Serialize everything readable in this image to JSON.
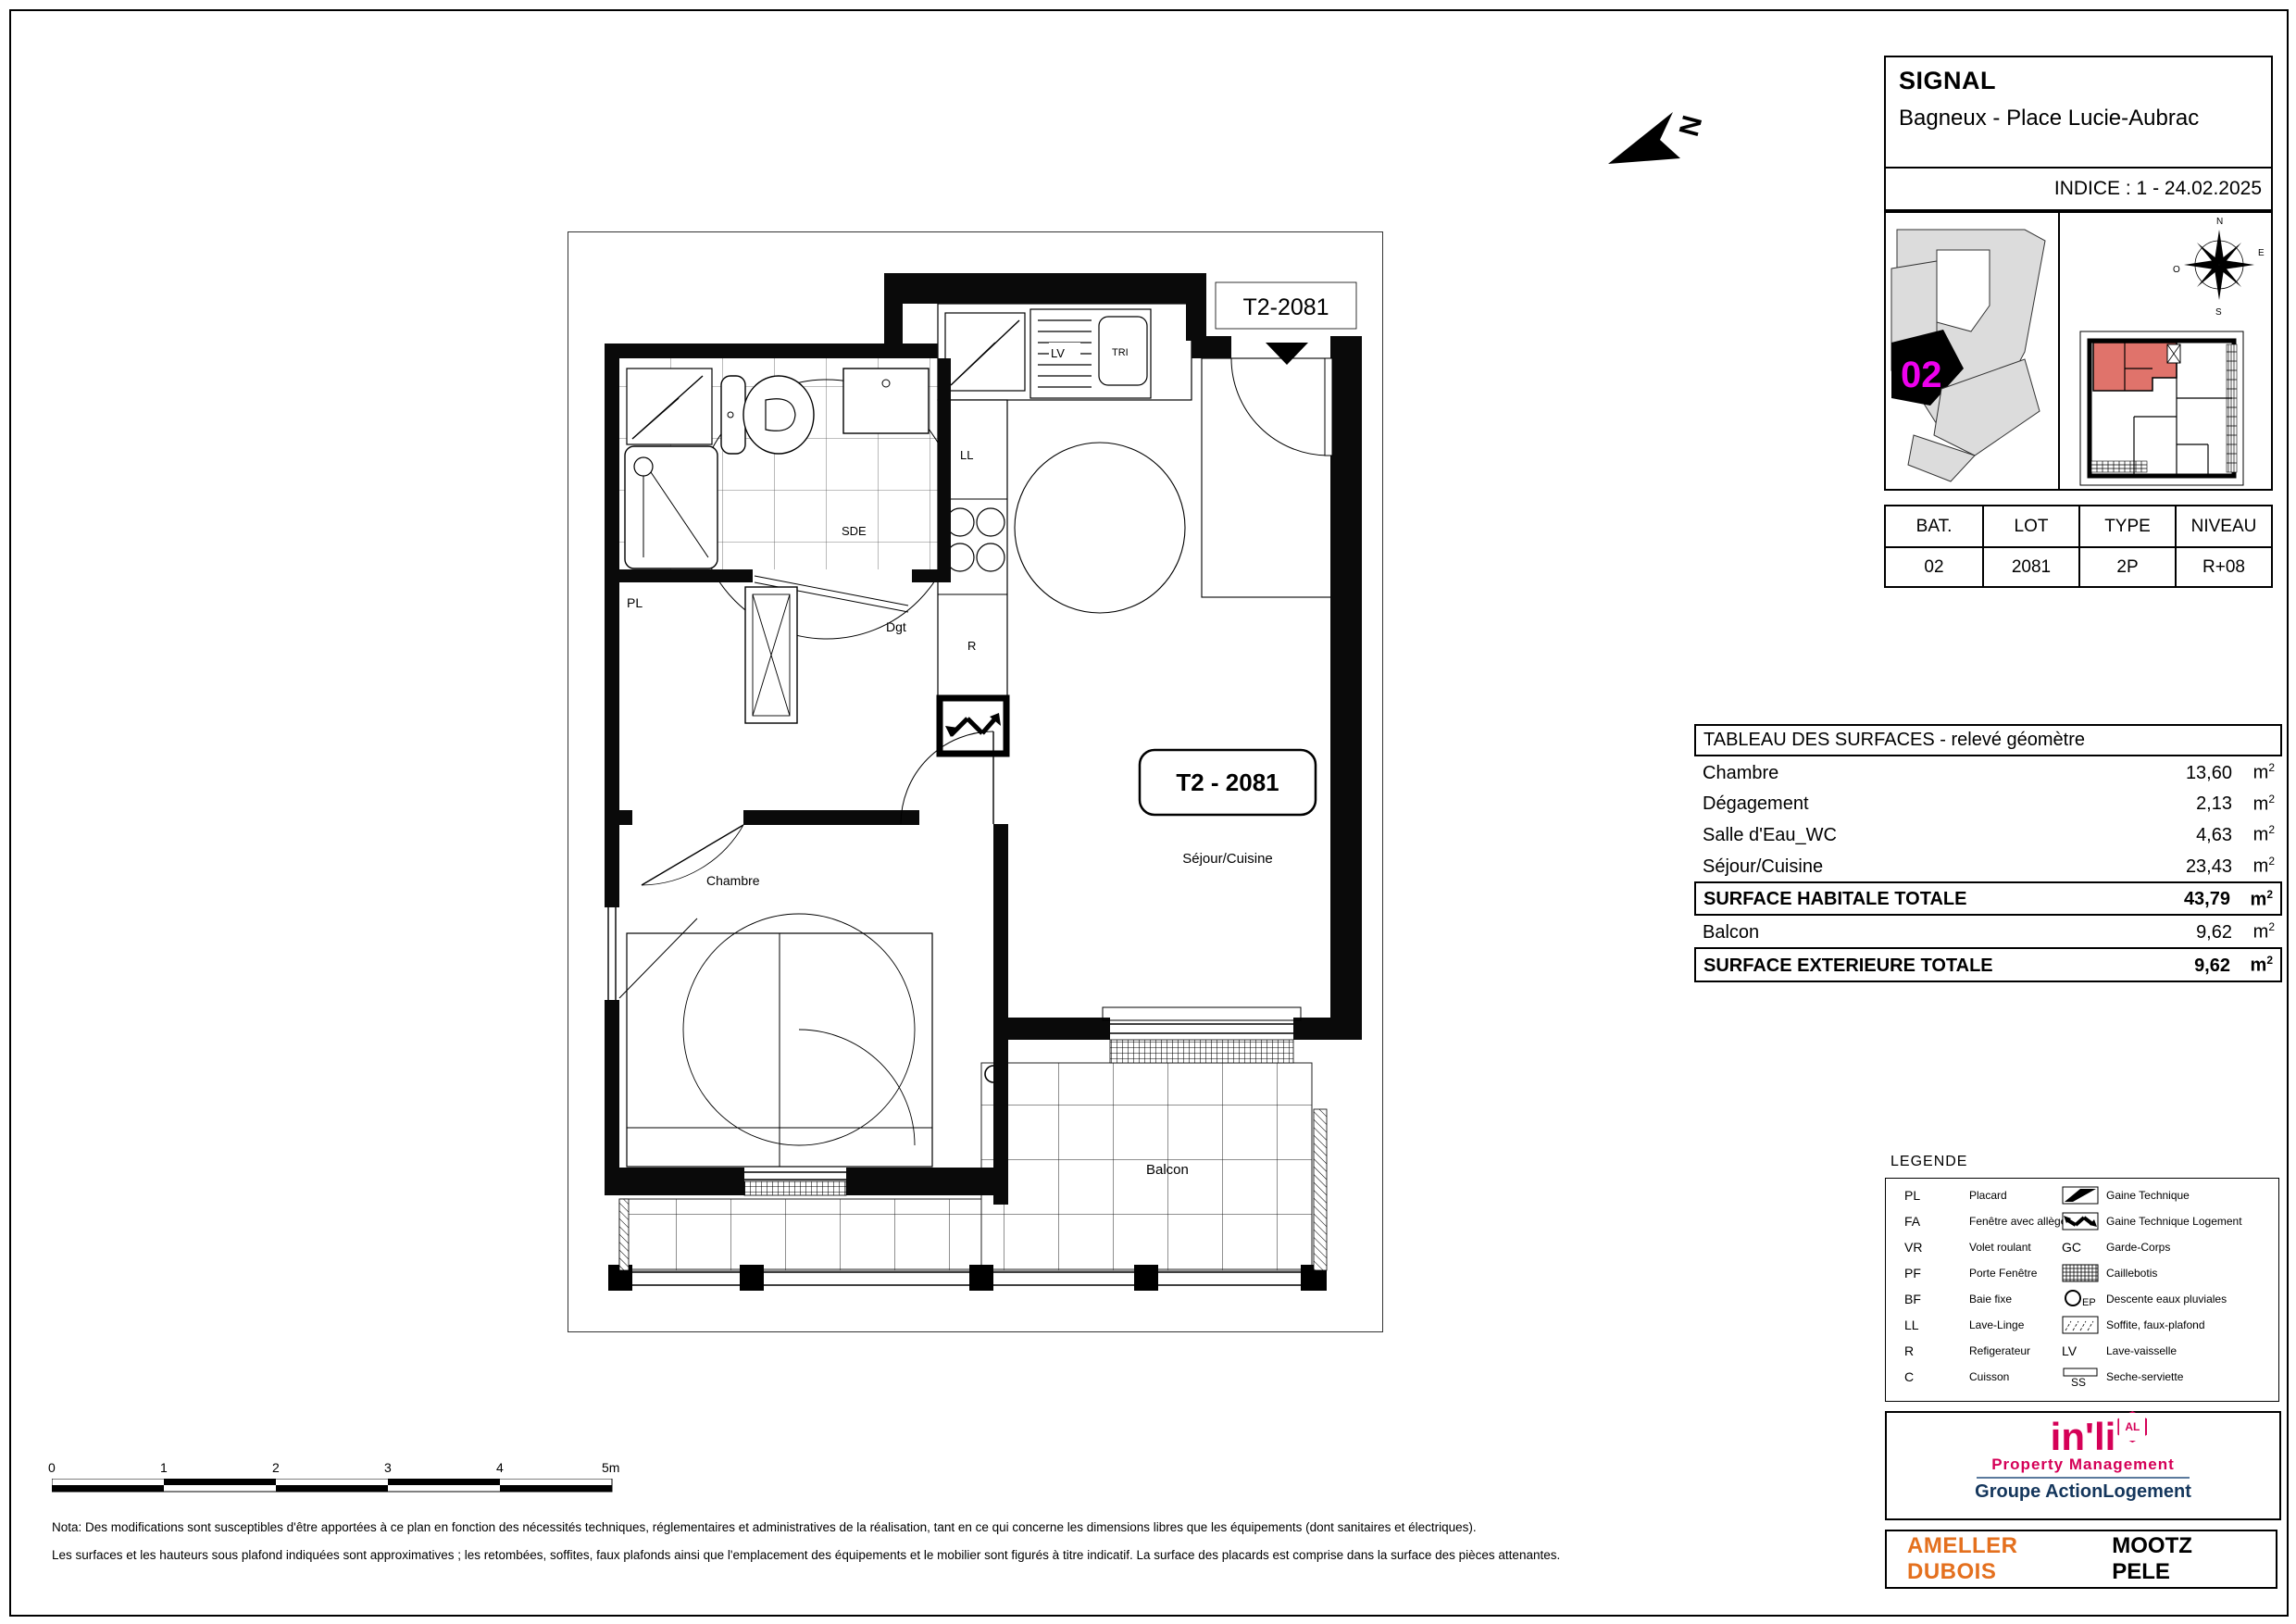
{
  "title_block": {
    "project": "SIGNAL",
    "location": "Bagneux - Place Lucie-Aubrac",
    "indice": "INDICE : 1 - 24.02.2025"
  },
  "site_plan": {
    "building_label": "02"
  },
  "compass": {
    "n": "N",
    "e": "E",
    "s": "S",
    "o": "O"
  },
  "north_arrow": {
    "label": "N"
  },
  "unit_table": {
    "headers": [
      "BAT.",
      "LOT",
      "TYPE",
      "NIVEAU"
    ],
    "values": [
      "02",
      "2081",
      "2P",
      "R+08"
    ]
  },
  "surfaces": {
    "title": "TABLEAU DES SURFACES - relevé géomètre",
    "unit": "m",
    "sup": "2",
    "rows": [
      {
        "label": "Chambre",
        "value": "13,60",
        "total": false
      },
      {
        "label": "Dégagement",
        "value": "2,13",
        "total": false
      },
      {
        "label": "Salle d'Eau_WC",
        "value": "4,63",
        "total": false
      },
      {
        "label": "Séjour/Cuisine",
        "value": "23,43",
        "total": false
      },
      {
        "label": "SURFACE HABITALE TOTALE",
        "value": "43,79",
        "total": true
      },
      {
        "label": "Balcon",
        "value": "9,62",
        "total": false
      },
      {
        "label": "SURFACE EXTERIEURE TOTALE",
        "value": "9,62",
        "total": true
      }
    ]
  },
  "legend": {
    "title": "LEGENDE",
    "left": [
      {
        "abbr": "PL",
        "label": "Placard"
      },
      {
        "abbr": "FA",
        "label": "Fenêtre avec allège"
      },
      {
        "abbr": "VR",
        "label": "Volet roulant"
      },
      {
        "abbr": "PF",
        "label": "Porte Fenêtre"
      },
      {
        "abbr": "BF",
        "label": "Baie fixe"
      },
      {
        "abbr": "LL",
        "label": "Lave-Linge"
      },
      {
        "abbr": "R",
        "label": "Refigerateur"
      },
      {
        "abbr": "C",
        "label": "Cuisson"
      }
    ],
    "right": [
      {
        "abbr": "",
        "label": "Gaine Technique"
      },
      {
        "abbr": "",
        "label": "Gaine Technique Logement"
      },
      {
        "abbr": "GC",
        "label": "Garde-Corps"
      },
      {
        "abbr": "",
        "label": "Caillebotis"
      },
      {
        "abbr": "EP",
        "label": "Descente eaux pluviales"
      },
      {
        "abbr": "",
        "label": "Soffite, faux-plafond"
      },
      {
        "abbr": "LV",
        "label": "Lave-vaisselle"
      },
      {
        "abbr": "SS",
        "label": "Seche-serviette"
      }
    ]
  },
  "plan": {
    "unit_top": "T2-2081",
    "unit_box": "T2 - 2081",
    "sejour": "Séjour/Cuisine",
    "chambre": "Chambre",
    "balcon": "Balcon",
    "sde": "SDE",
    "dgt": "Dgt",
    "pl": "PL",
    "ll": "LL",
    "r": "R",
    "lv": "LV",
    "tri": "TRI"
  },
  "scale_bar": {
    "labels": [
      "0",
      "1",
      "2",
      "3",
      "4",
      "5m"
    ]
  },
  "nota": {
    "line1": "Nota: Des modifications sont susceptibles d'être apportées à ce plan en fonction des nécessités techniques, réglementaires et administratives de la réalisation, tant en ce qui concerne les dimensions libres que les équipements (dont sanitaires et électriques).",
    "line2": "Les surfaces et les hauteurs sous plafond indiquées sont approximatives ; les retombées, soffites, faux plafonds ainsi que l'emplacement des équipements et le mobilier sont figurés à titre indicatif. La surface des placards est comprise dans la surface des pièces attenantes."
  },
  "logos": {
    "inli": "in'li",
    "al": "AL",
    "property_management": "Property Management",
    "groupe_action": "Groupe Action",
    "logement": "Logement",
    "ameller": "AMELLER DUBOIS",
    "mootz": "MOOTZ PELE"
  },
  "colors": {
    "magenta": "#EE00EE",
    "unit_fill": "#E0736B",
    "inli_pink": "#D50057",
    "navy": "#14365C",
    "orange": "#E4701E"
  }
}
